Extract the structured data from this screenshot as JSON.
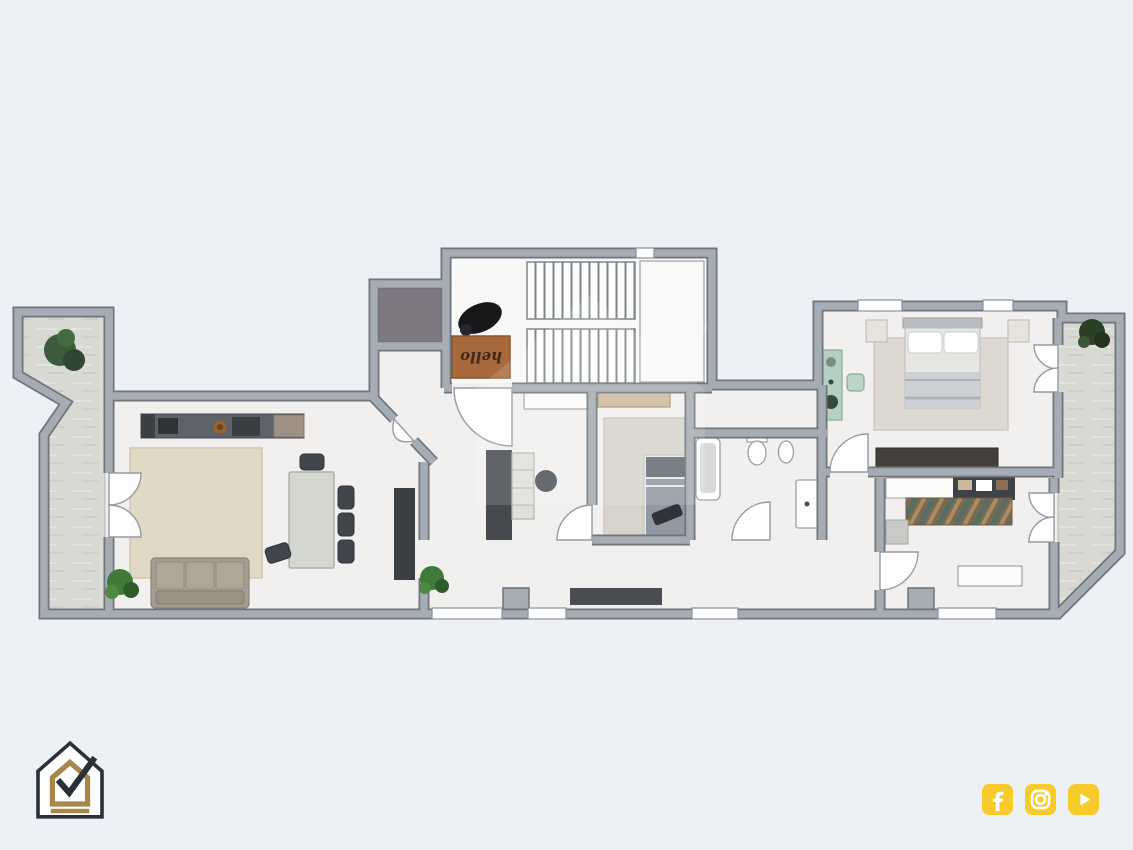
{
  "scene": {
    "description": "Top-down rendered apartment floor plan flyer",
    "background_color": "#EDF0F5"
  },
  "floor_plan": {
    "doormat_text": "hello",
    "watermark_icon": "house-check-watermark",
    "wall_color": "#A6ACB4",
    "floor_color": "#F1F0EE",
    "terrace_color": "#D9D9D4"
  },
  "branding": {
    "logo_icon": "house-check-logo",
    "logo_outline_color": "#2A3038",
    "logo_gold_color": "#A8854A"
  },
  "social": {
    "accent_color": "#F8CB2D",
    "icons": [
      {
        "name": "facebook-icon"
      },
      {
        "name": "instagram-icon"
      },
      {
        "name": "youtube-icon"
      }
    ]
  }
}
